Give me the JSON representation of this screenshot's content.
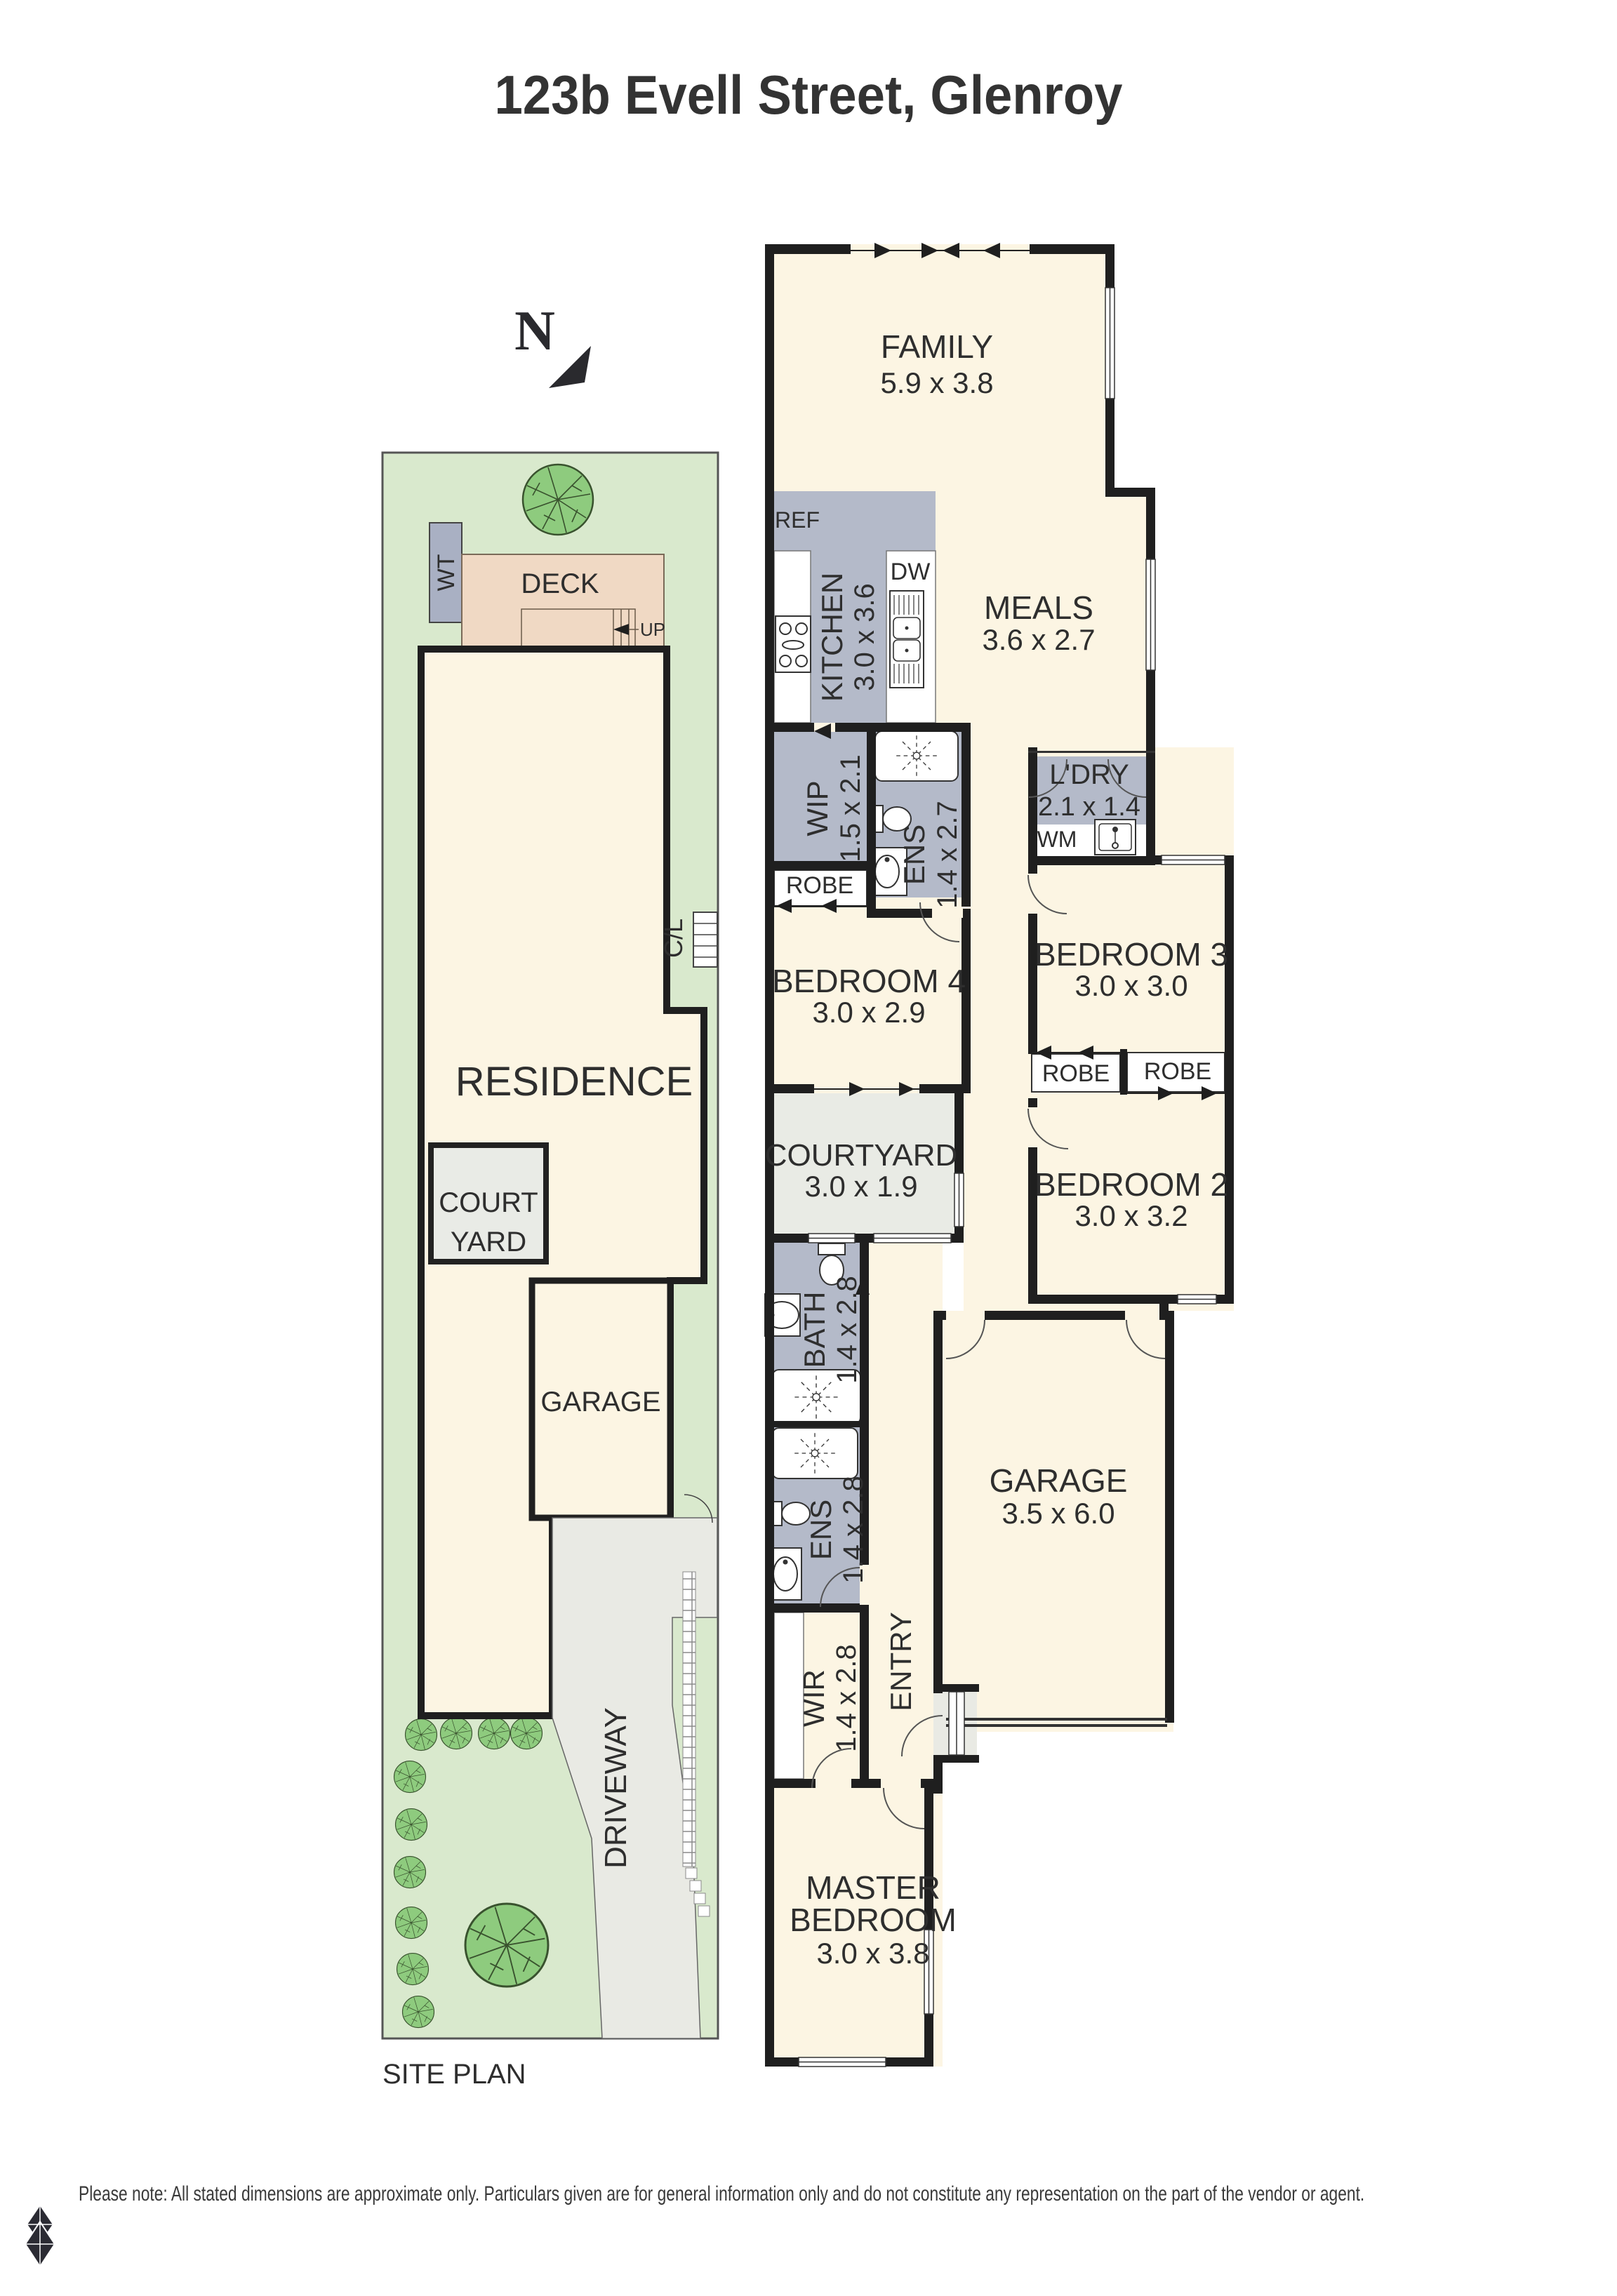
{
  "title": "123b Evell Street, Glenroy",
  "north_indicator": "N",
  "site_plan": {
    "caption": "SITE PLAN",
    "labels": {
      "water_tank": "WT",
      "deck": "DECK",
      "stairs_up": "UP",
      "clothesline": "C/L",
      "residence": "RESIDENCE",
      "courtyard_line1": "COURT",
      "courtyard_line2": "YARD",
      "garage": "GARAGE",
      "driveway": "DRIVEWAY"
    }
  },
  "floor_plan": {
    "rooms": {
      "family": {
        "name": "FAMILY",
        "dims": "5.9 x 3.8"
      },
      "kitchen": {
        "name": "KITCHEN",
        "dims": "3.0 x 3.6"
      },
      "meals": {
        "name": "MEALS",
        "dims": "3.6 x 2.7"
      },
      "wip": {
        "name": "WIP",
        "dims": "1.5 x 2.1"
      },
      "ens_upper": {
        "name": "ENS",
        "dims": "1.4 x 2.7"
      },
      "laundry": {
        "name": "L'DRY",
        "dims": "2.1 x 1.4"
      },
      "bedroom4": {
        "name": "BEDROOM 4",
        "dims": "3.0 x 2.9"
      },
      "bedroom3": {
        "name": "BEDROOM 3",
        "dims": "3.0 x 3.0"
      },
      "courtyard": {
        "name": "COURTYARD",
        "dims": "3.0 x 1.9"
      },
      "bedroom2": {
        "name": "BEDROOM 2",
        "dims": "3.0 x 3.2"
      },
      "bath": {
        "name": "BATH",
        "dims": "1.4 x 2.8"
      },
      "ens_lower": {
        "name": "ENS",
        "dims": "1.4 x 2.8"
      },
      "garage": {
        "name": "GARAGE",
        "dims": "3.5 x 6.0"
      },
      "wir": {
        "name": "WIR",
        "dims": "1.4 x 2.8"
      },
      "entry": {
        "name": "ENTRY"
      },
      "master": {
        "name_line1": "MASTER",
        "name_line2": "BEDROOM",
        "dims": "3.0 x 3.8"
      }
    },
    "fixture_labels": {
      "fridge": "REF",
      "dishwasher": "DW",
      "washing_machine": "WM",
      "robe_bedroom4": "ROBE",
      "robe_bedroom3": "ROBE",
      "robe_bedroom2": "ROBE"
    }
  },
  "disclaimer": "Please note: All stated dimensions are approximate only. Particulars given are for general information only and do not constitute any representation on the part of the vendor or agent.",
  "colors": {
    "wall": "#1f1f1f",
    "floor_cream": "#fcf5e3",
    "wet_area_grey": "#b4bac9",
    "paving_grey": "#e9eae4",
    "site_grass": "#d9e9cd",
    "tree_green": "#8ecb7e",
    "deck_tan": "#f0d9c4",
    "water_tank_grey": "#a9b0c3"
  }
}
